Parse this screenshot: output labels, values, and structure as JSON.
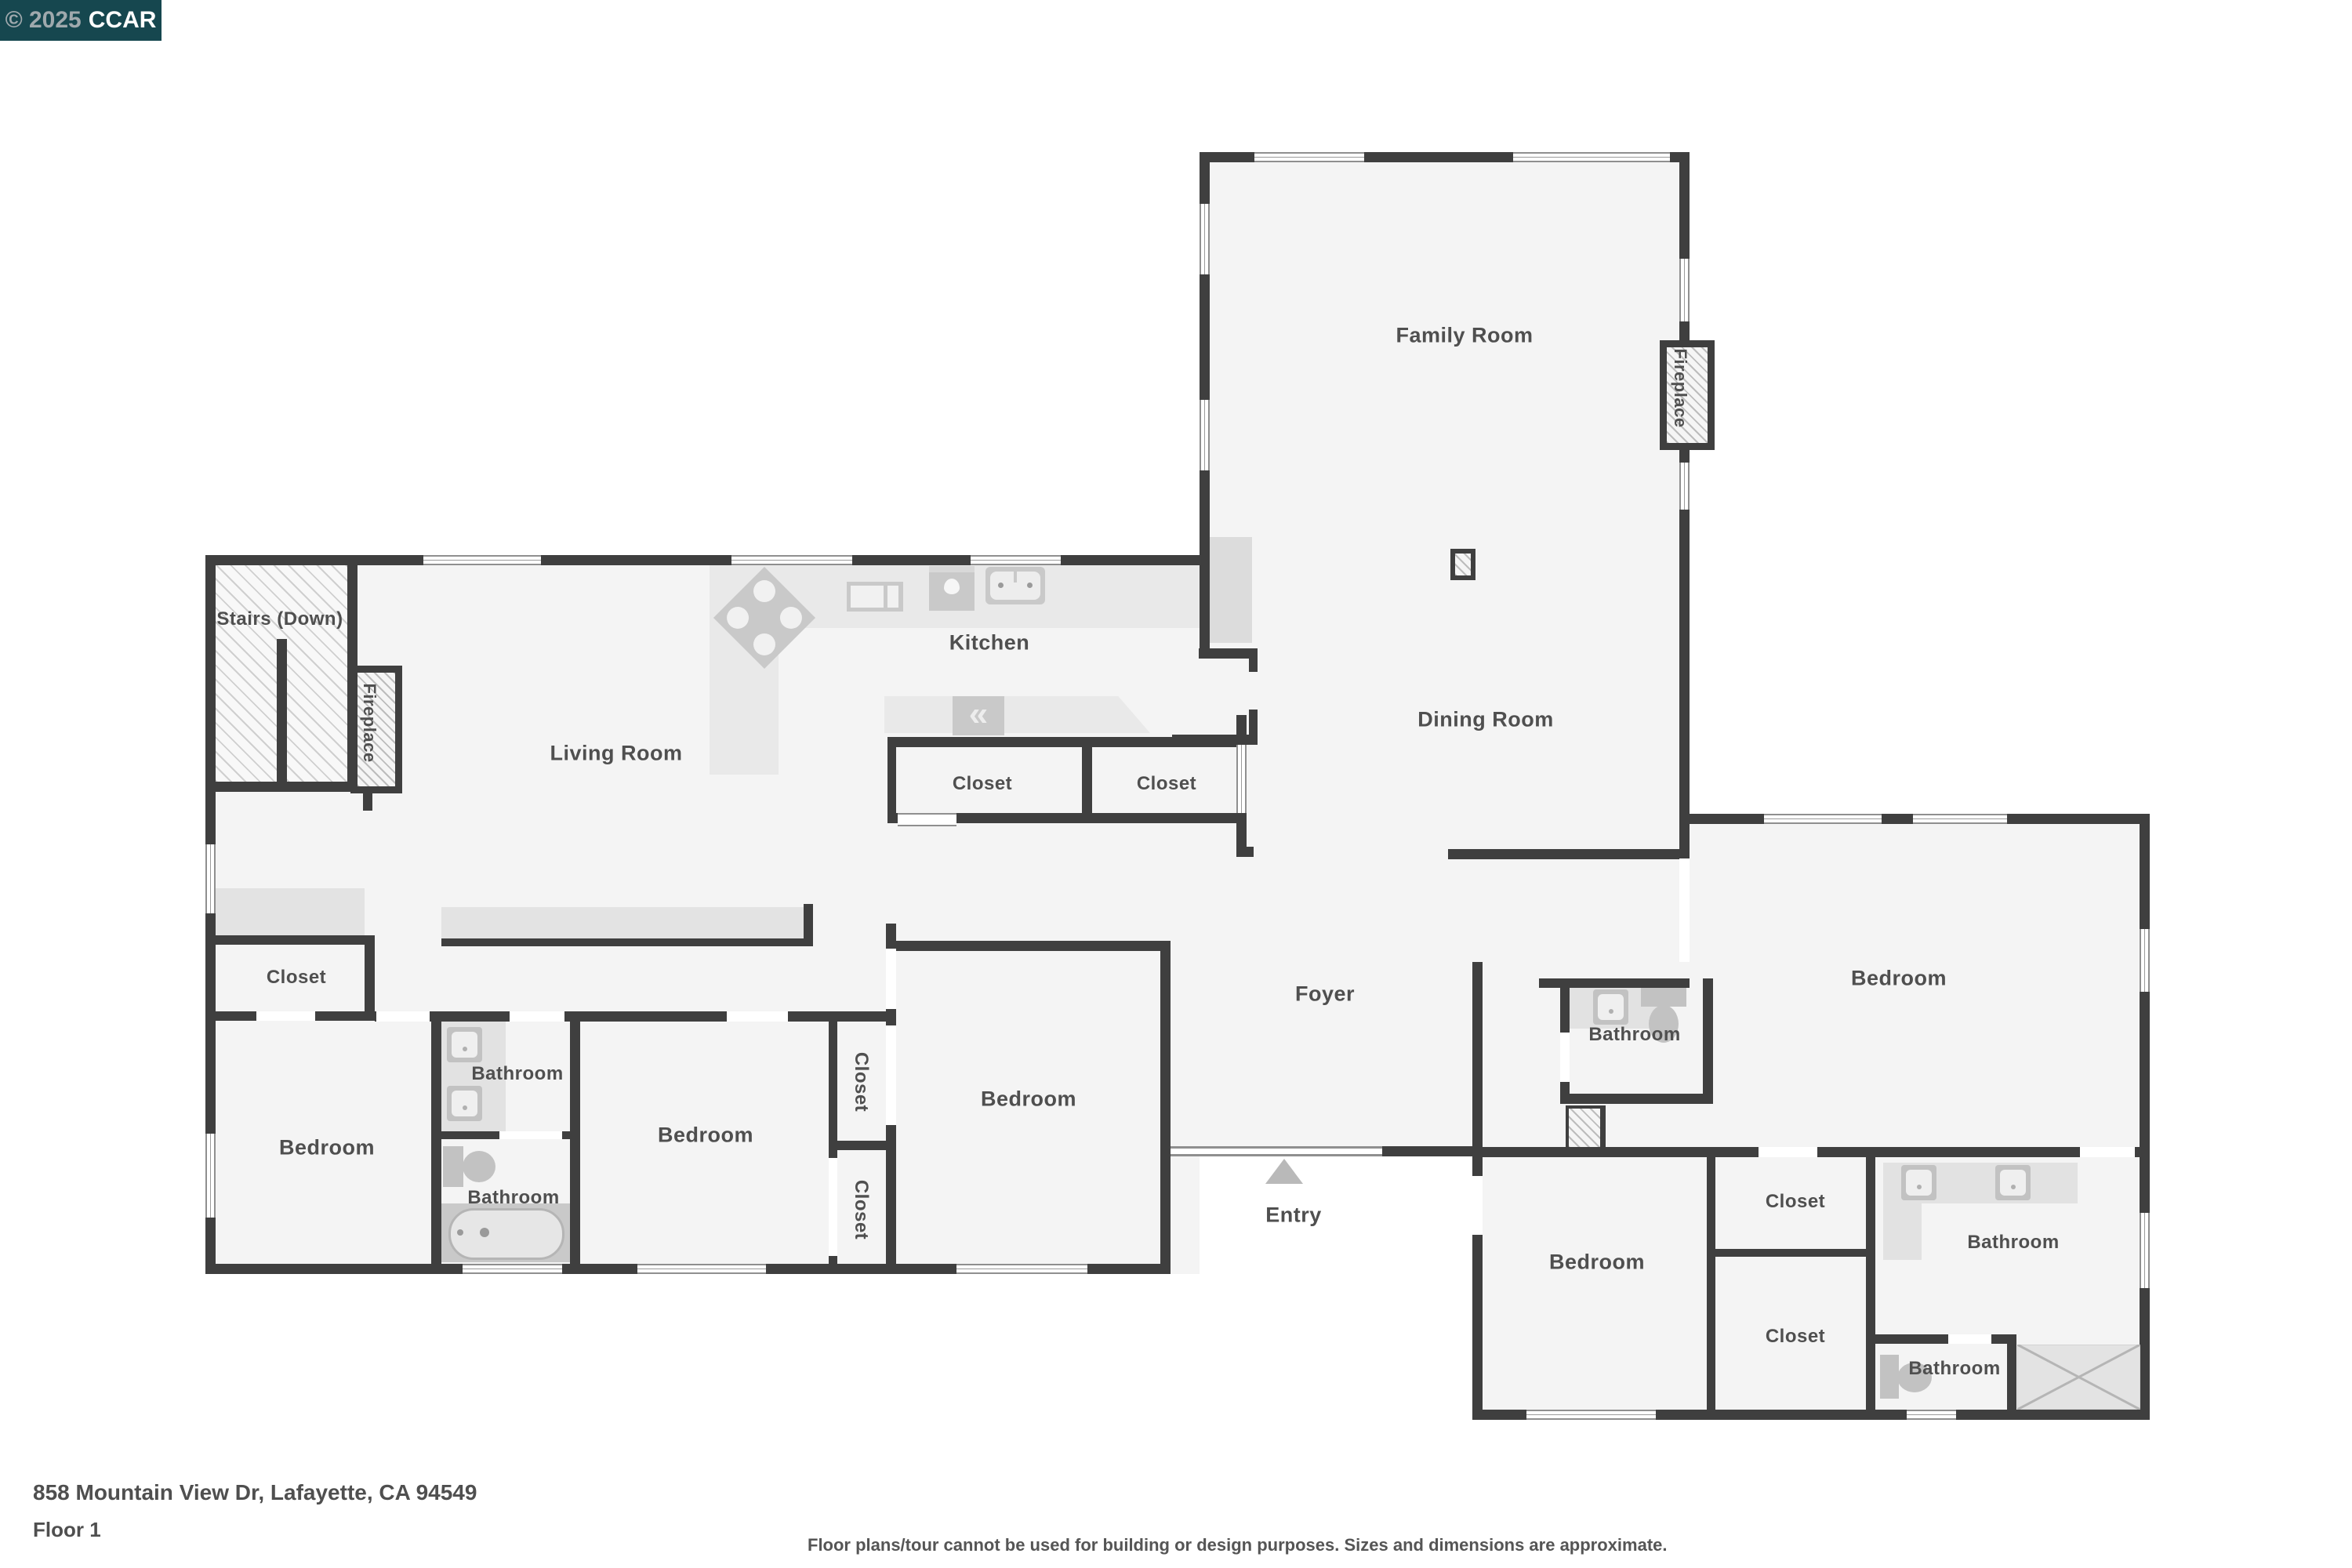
{
  "watermark": {
    "copyright": "© 2025",
    "org": "CCAR"
  },
  "rooms": {
    "stairs": "Stairs (Down)",
    "living": "Living Room",
    "kitchen": "Kitchen",
    "family": "Family Room",
    "dining": "Dining Room",
    "foyer": "Foyer",
    "entry": "Entry",
    "bedroom": "Bedroom",
    "bathroom": "Bathroom",
    "closet": "Closet",
    "fireplace": "Fireplace"
  },
  "footer": {
    "address": "858 Mountain View Dr, Lafayette, CA 94549",
    "floor": "Floor 1",
    "disclaimer": "Floor plans/tour cannot be used for building or design purposes. Sizes and dimensions are approximate."
  },
  "colors": {
    "wall": "#3f3f3f",
    "floor": "#f4f4f4",
    "counter": "#e9e9e9",
    "fixture": "#c9c9c9",
    "watermark_bg": "#16474f",
    "label": "#4f4f4f"
  }
}
